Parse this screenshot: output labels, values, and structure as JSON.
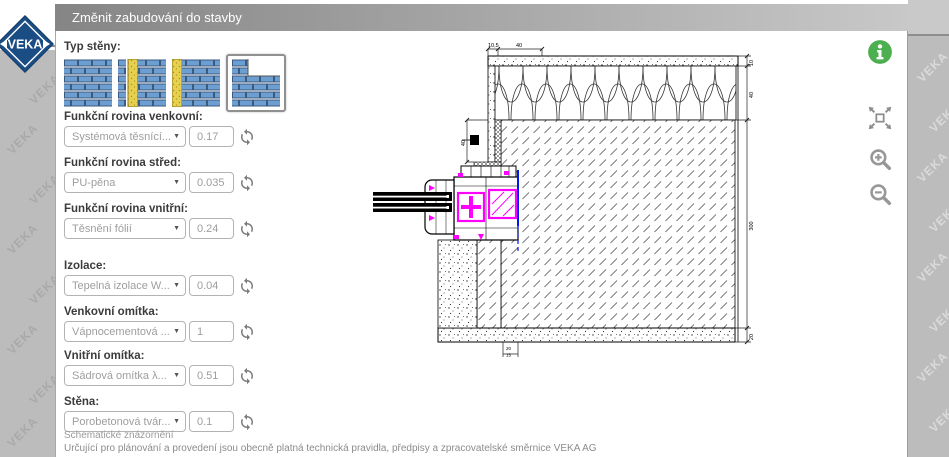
{
  "window": {
    "title": "Změnit zabudování do stavby"
  },
  "logo": {
    "text": "VEKA"
  },
  "background": {
    "watermark": "VEKA"
  },
  "icons": {
    "dropdown_arrow": "▼"
  },
  "toolbar": {
    "icon_names": [
      "info-icon",
      "fit-screen-icon",
      "zoom-in-icon",
      "zoom-out-icon"
    ]
  },
  "panel": {
    "wall_type_label": "Typ stěny:",
    "wall_types": [
      {
        "name": "masonry-solid",
        "selected": false
      },
      {
        "name": "masonry-core-insulation",
        "selected": false
      },
      {
        "name": "masonry-exterior-insulation",
        "selected": false
      },
      {
        "name": "masonry-corner-detail",
        "selected": true
      }
    ],
    "fields": [
      {
        "label": "Funkční rovina venkovní:",
        "option": "Systémová těsnící...",
        "value": "0.17"
      },
      {
        "label": "Funkční rovina střed:",
        "option": "PU-pěna",
        "value": "0.035"
      },
      {
        "label": "Funkční rovina vnitřní:",
        "option": "Těsnění fólií",
        "value": "0.24"
      },
      {
        "label": "Izolace:",
        "option": "Tepelná izolace W...",
        "value": "0.04"
      },
      {
        "label": "Venkovní omítka:",
        "option": "Vápnocementová ...",
        "value": "1"
      },
      {
        "label": "Vnitřní omítka:",
        "option": "Sádrová omítka λ...",
        "value": "0.51"
      },
      {
        "label": "Stěna:",
        "option": "Porobetonová tvár...",
        "value": "0.1"
      }
    ],
    "notes": {
      "line1": "Schematické znázornění",
      "line2": "Určující pro plánování a provedení jsou obecně platná technická pravidla, předpisy a zpracovatelské směrnice VEKA AG"
    }
  },
  "drawing": {
    "dims": {
      "top": [
        "10,5",
        "40"
      ],
      "right": [
        "10",
        "40",
        "300",
        "20"
      ],
      "reveal": "40",
      "bottom": [
        "20",
        "15"
      ]
    }
  }
}
